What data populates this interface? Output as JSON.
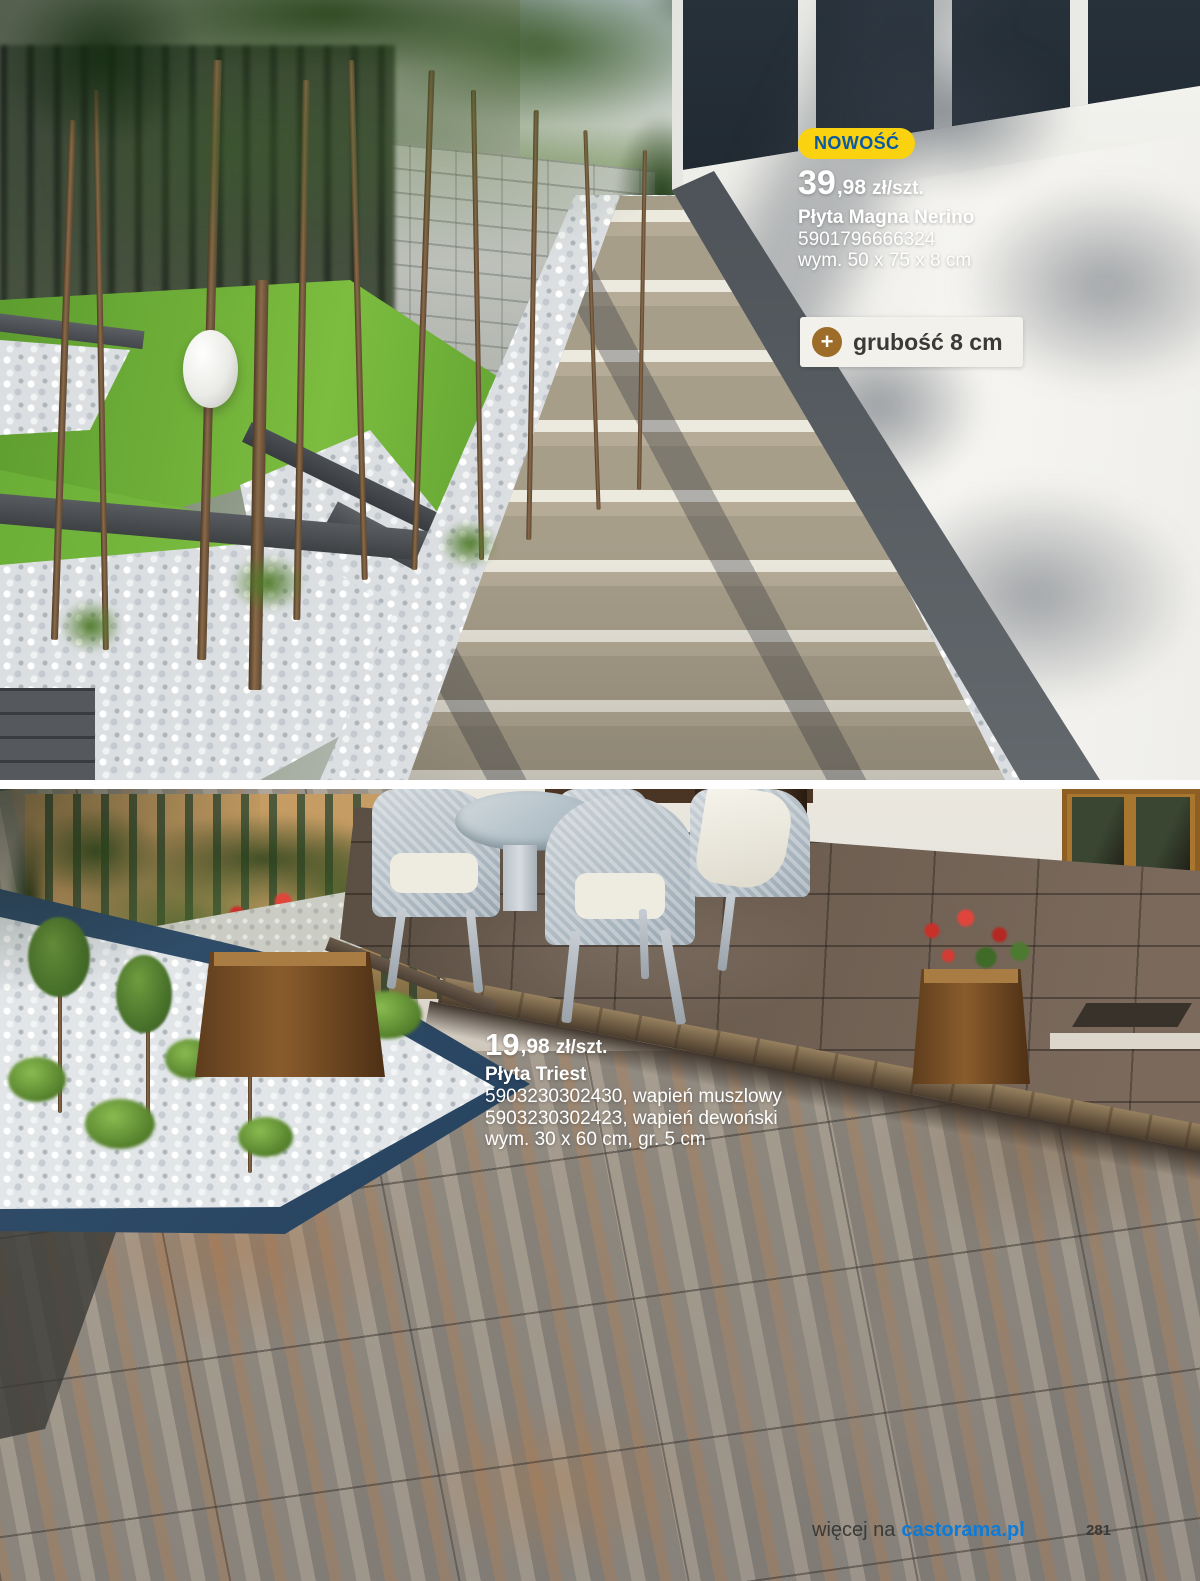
{
  "products": [
    {
      "badge": "NOWOŚĆ",
      "price_main": "39",
      "price_decimal": ",98",
      "price_unit": "zł/szt.",
      "name": "Płyta Magna Nerino",
      "ean": "5901796666324",
      "dimensions": "wym. 50 x 75 x 8 cm",
      "feature": "grubość 8 cm"
    },
    {
      "price_main": "19",
      "price_decimal": ",98",
      "price_unit": "zł/szt.",
      "name": "Płyta Triest",
      "variant1": "5903230302430, wapień muszlowy",
      "variant2": "5903230302423, wapień dewoński",
      "dimensions": "wym. 30 x 60 cm, gr. 5 cm"
    }
  ],
  "footer": {
    "prefix": "więcej na",
    "site": "castorama.pl",
    "page": "281"
  },
  "icons": {
    "plus": "+"
  },
  "colors": {
    "badge_yellow": "#fbd20f",
    "badge_text_blue": "#0a5aa5",
    "link_blue": "#0d7bd7",
    "plus_circle_brown": "#9d6c28",
    "island_edging_navy": "#2b4866"
  }
}
